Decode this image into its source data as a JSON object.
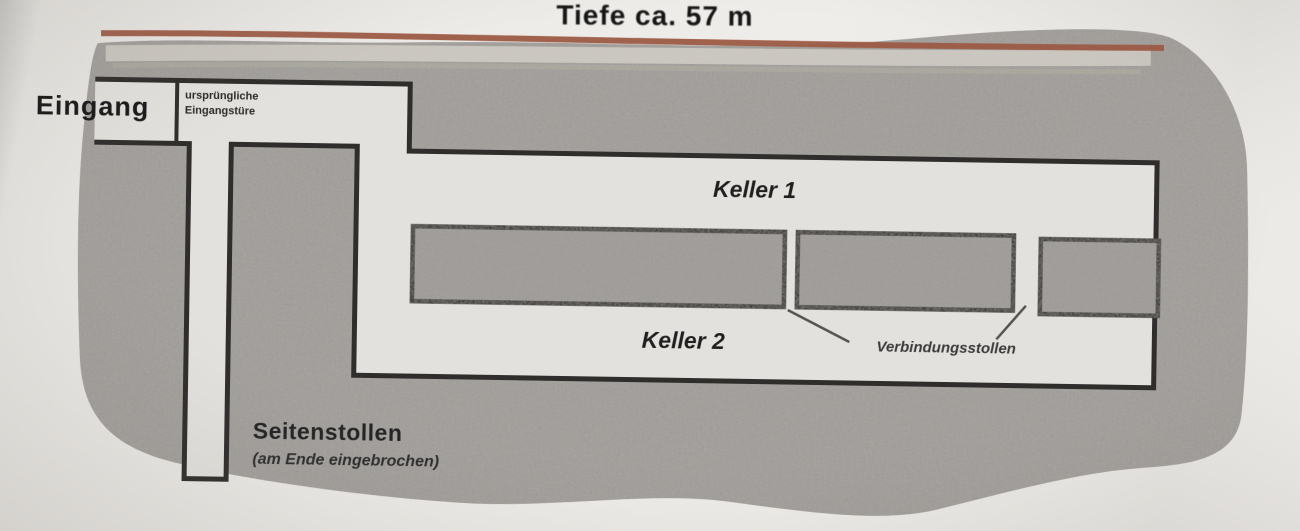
{
  "title": "Tiefe ca. 57 m",
  "diagram": {
    "entrance_label": "Eingang",
    "entrance_note_line1": "ursprüngliche",
    "entrance_note_line2": "Eingangstüre",
    "chamber1_label": "Keller 1",
    "chamber2_label": "Keller 2",
    "connecting_tunnels_label": "Verbindungsstollen",
    "side_tunnel_label": "Seitenstollen",
    "side_tunnel_note": "(am Ende eingebrochen)",
    "colors": {
      "surface_line": "#9d5b44",
      "rock": "#a8a5a1",
      "tunnel": "#e3e1dd",
      "outline": "#2f2e2c"
    }
  }
}
